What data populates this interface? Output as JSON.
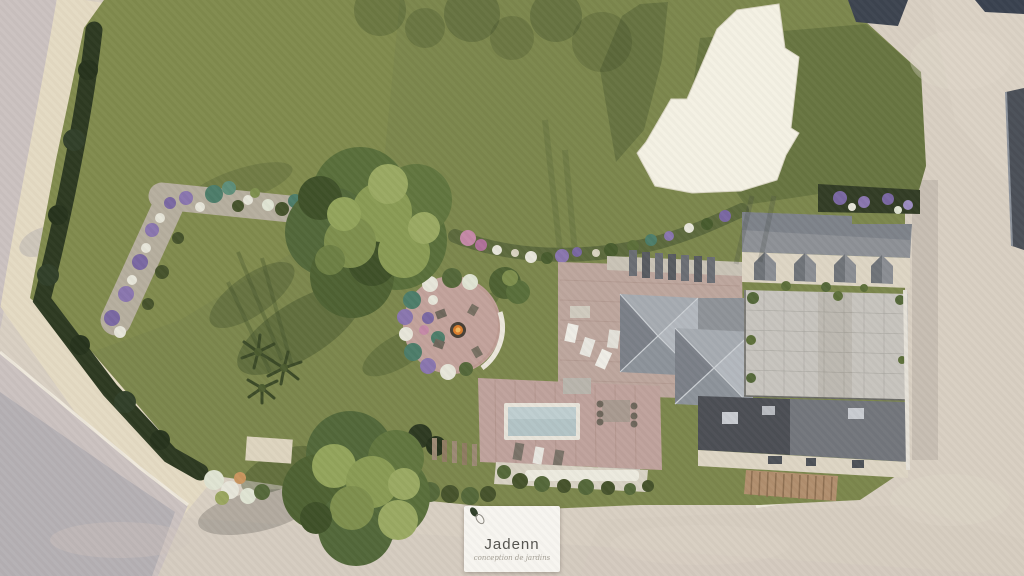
{
  "scene": {
    "type": "aerial-3d-garden-render",
    "view": "top-down landscape design visualization of a walled property",
    "elements": [
      "lawn",
      "left-gravel-path",
      "boundary-hedge",
      "l-shaped-flower-bed",
      "mixed-flower-border",
      "fire-pit-patio",
      "palm-cluster",
      "large-north-tree",
      "large-south-tree",
      "white-direction-arrow",
      "main-house-turret-roofs",
      "roof-terrace-with-loungers",
      "north-wing-with-dormers",
      "paved-courtyard",
      "street-wing",
      "wooden-gate-fence",
      "swimming-pool",
      "pool-terrace",
      "outdoor-dining-set",
      "planter-bench-border",
      "perimeter-roads"
    ]
  },
  "logo": {
    "brand": "Jadenn",
    "tagline": "conception de jardins"
  },
  "icons": {
    "leaf_logo": "two stylized leaves, one solid dark olive and one outlined"
  },
  "colors": {
    "lawn": "#7c874d",
    "lawn_shadow": "#4d5c31",
    "hedge": "#2e3a22",
    "pavement": "#d8cfc2",
    "gravel_path": "#e4dac3",
    "road_gray": "#cbc2c0",
    "roof_light": "#a6abb1",
    "roof_dark": "#4c4f55",
    "facade_cream": "#ddd5c4",
    "courtyard_pavers": "#c7c4be",
    "deck_pink": "#bda69d",
    "pool_water": "#b3c4c6",
    "arrow_white": "#f4f1e3",
    "fence_wood": "#b18f6e",
    "flower_purple": "#8a76ae",
    "flower_pink": "#c489a6",
    "flower_white": "#e7e5d9",
    "succulent_teal": "#4e7d6a",
    "fire_pit": "#d97c2c",
    "logo_card_bg": "#f7f5f0",
    "logo_text": "#55544f"
  }
}
